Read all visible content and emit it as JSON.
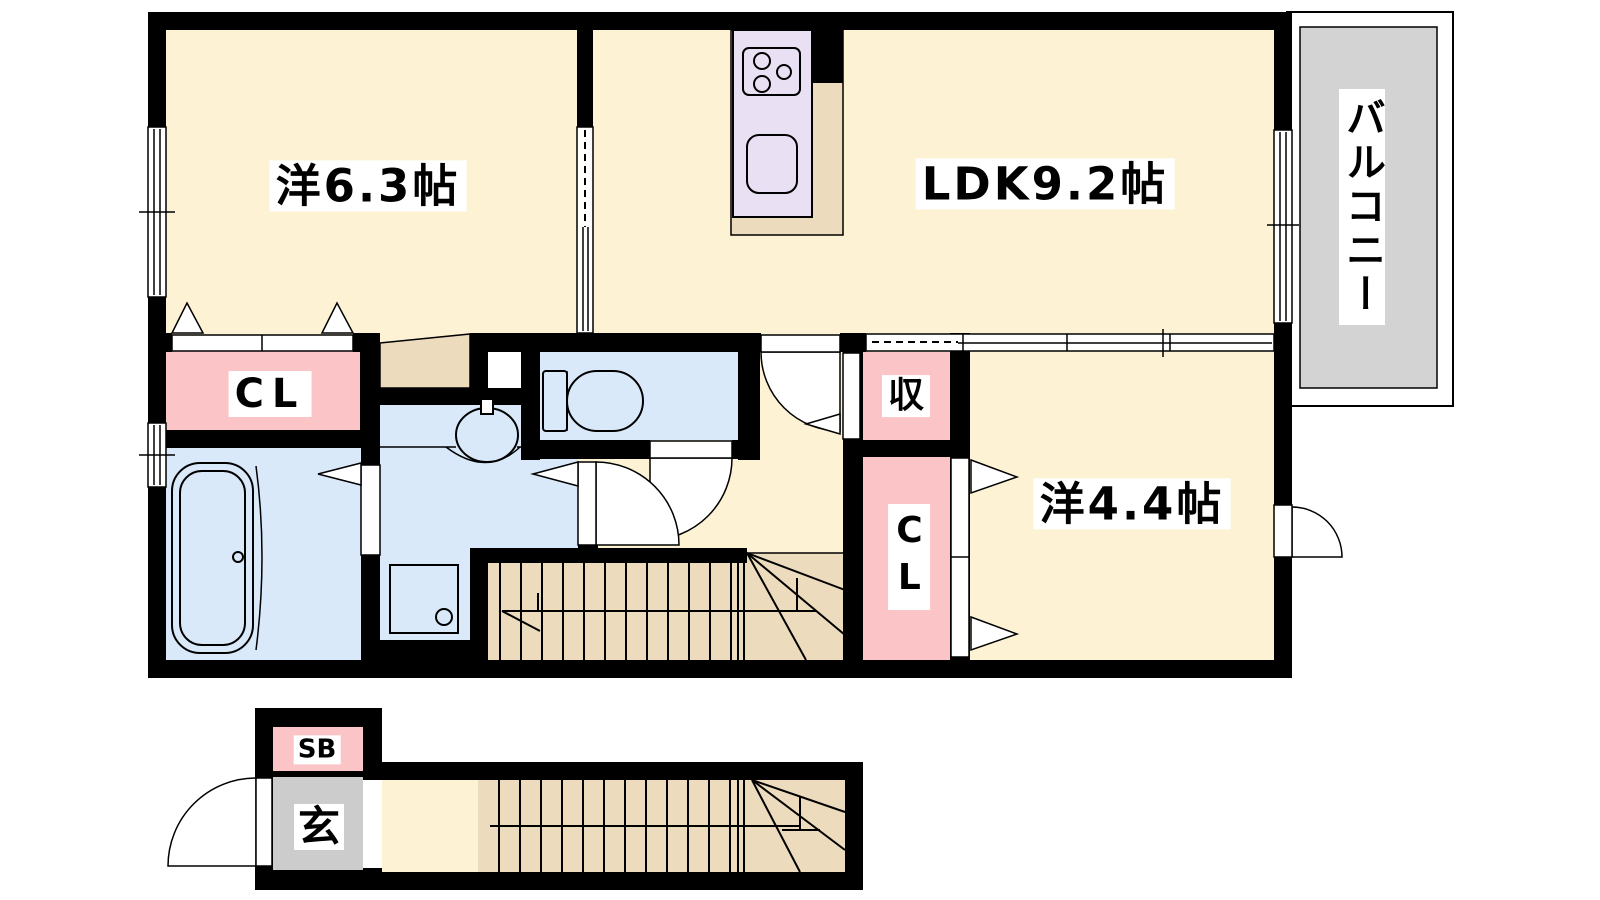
{
  "floorplan": {
    "title": "2LDK apartment floor plan",
    "rooms": {
      "bedroom1": {
        "label": "洋6.3帖"
      },
      "ldk": {
        "label": "LDK9.2帖"
      },
      "bedroom2": {
        "label": "洋4.4帖"
      },
      "balcony": {
        "label": "バルコニー"
      },
      "closet1": {
        "label": "CL"
      },
      "storage": {
        "label": "収"
      },
      "closet2": {
        "label": "CL"
      },
      "shoe_box": {
        "label": "SB"
      },
      "entrance": {
        "label": "玄"
      }
    },
    "colors": {
      "wall": "#000000",
      "room_floor": "#fdf3d4",
      "wood": "#ecdbbc",
      "water": "#d9e9fa",
      "closet_pink": "#fbc5c7",
      "kitchen_counter": "#e9e0f3",
      "balcony_gray": "#d3d3d3",
      "entrance_gray": "#cccccc"
    }
  }
}
